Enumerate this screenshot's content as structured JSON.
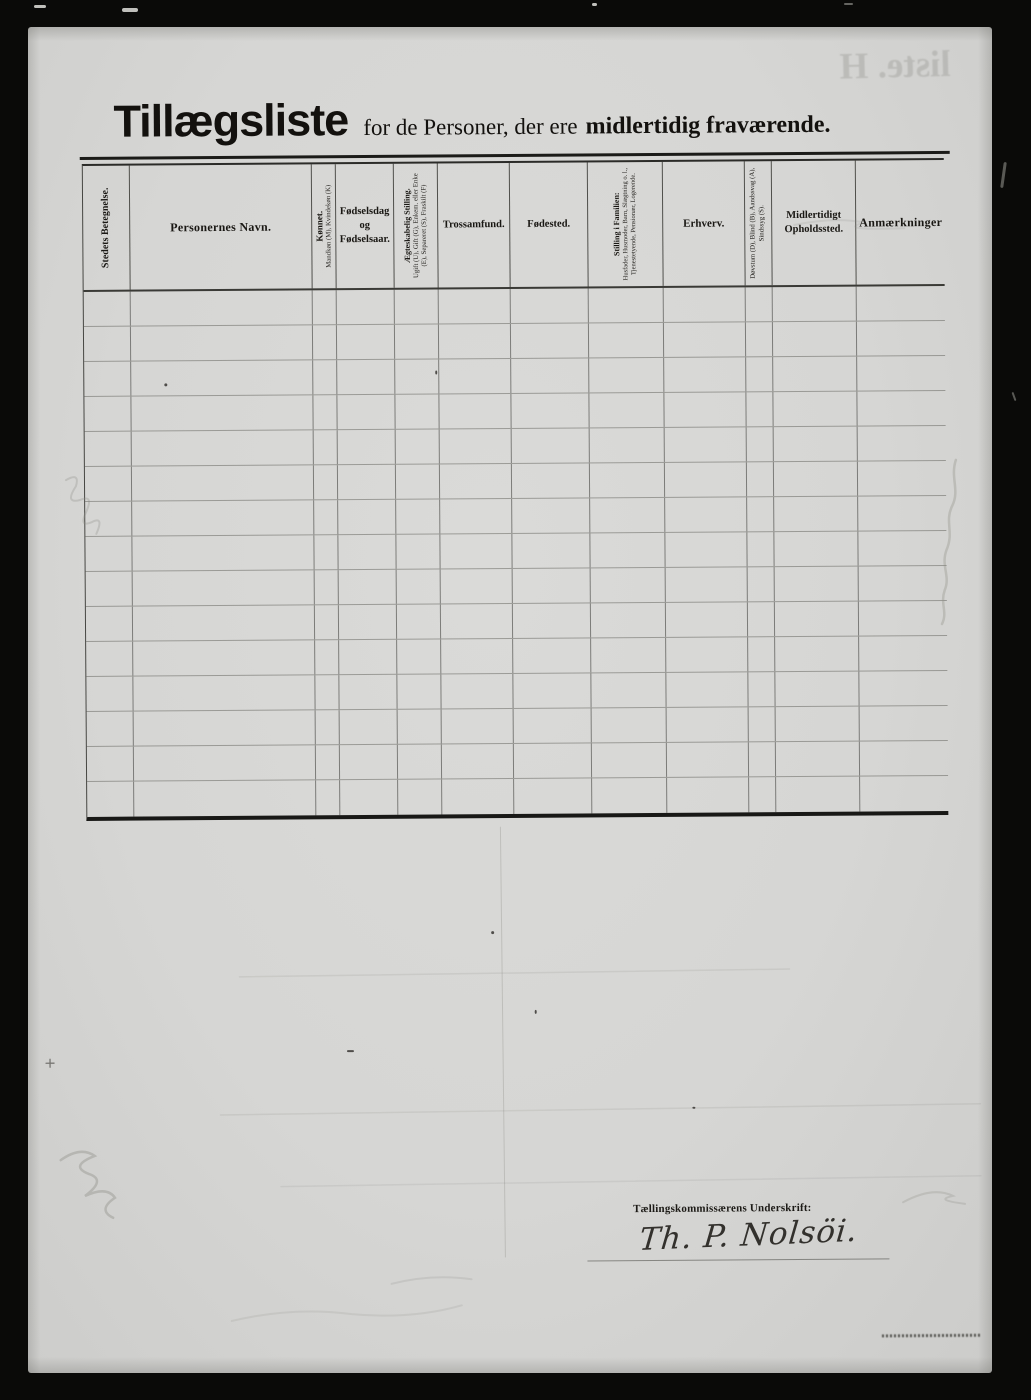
{
  "page": {
    "title_main": "Tillægsliste",
    "title_mid": "for de Personer, der ere",
    "title_bold": "midlertidig fraværende.",
    "bleedthrough_text": "liste. H",
    "paper_color": "#d8d8d6",
    "ink_color": "#181613",
    "scan_background_color": "#0a0a08"
  },
  "table": {
    "row_count": 15,
    "columns": [
      {
        "id": "stedets-betegnelse",
        "label": "Stedets Betegnelse.",
        "orientation": "vertical"
      },
      {
        "id": "personernes-navn",
        "label": "Personernes Navn.",
        "orientation": "horizontal"
      },
      {
        "id": "koennet",
        "label": "Kønnet.",
        "sub": "Mandkøn (M), Kvindekøn (K)",
        "orientation": "vertical"
      },
      {
        "id": "foedselsdag",
        "label": "Fødselsdag og Fødselsaar.",
        "orientation": "horizontal"
      },
      {
        "id": "aegteskabelig-stilling",
        "label": "Ægteskabelig Stilling.",
        "sub": "Ugift (U), Gift (G), Enkem. eller Enke (E), Separeret (S), Fraskilt (F)",
        "orientation": "vertical"
      },
      {
        "id": "trossamfund",
        "label": "Trossamfund.",
        "orientation": "horizontal"
      },
      {
        "id": "foedested",
        "label": "Fødested.",
        "orientation": "horizontal"
      },
      {
        "id": "stilling-i-familien",
        "label": "Stilling i Familien:",
        "sub": "Husfader, Husmoder, Barn, Slægtning o. l., Tjenestetyende, Pensionær, Logerende.",
        "orientation": "vertical"
      },
      {
        "id": "erhverv",
        "label": "Erhverv.",
        "orientation": "horizontal"
      },
      {
        "id": "doevstum",
        "label": "Døvstum (D), Blind (B), Aandssvag (A), Sindssyg (S).",
        "orientation": "vertical"
      },
      {
        "id": "midlertidigt-opholdssted",
        "label": "Midlertidigt Opholdssted.",
        "orientation": "horizontal"
      },
      {
        "id": "anmaerkninger",
        "label": "Anmærkninger",
        "orientation": "horizontal"
      }
    ]
  },
  "signature": {
    "label": "Tællingskommissærens Underskrift:",
    "value": "Th. P. Nolsöi."
  }
}
